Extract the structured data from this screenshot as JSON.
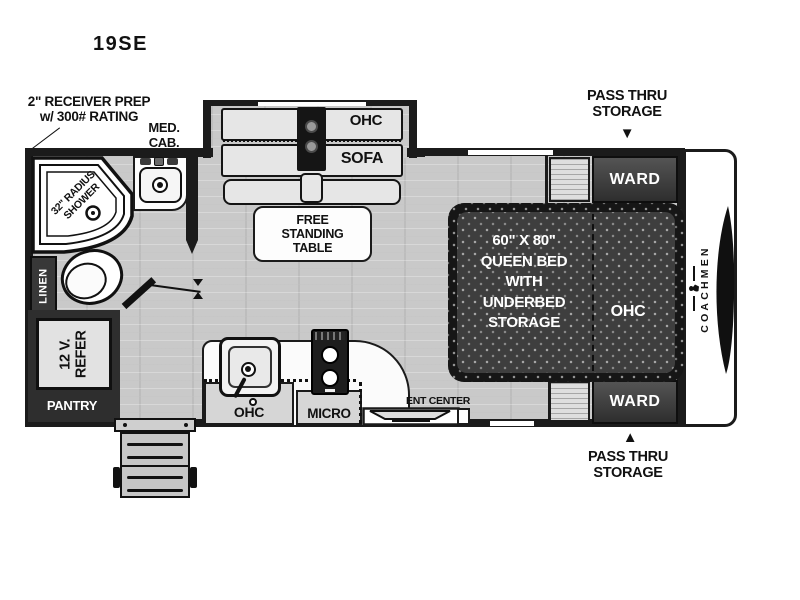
{
  "colors": {
    "wall": "#1b1b1b",
    "floor": "#c9c9c9",
    "bed": "#3e3e3e",
    "cabinet-dark": "#383838",
    "furniture-light": "#e6e6e6",
    "label-ink": "#111111"
  },
  "title": "19SE",
  "callouts": {
    "receiver_line1": "2\" RECEIVER PREP",
    "receiver_line2": "w/ 300# RATING",
    "med_cab_line1": "MED.",
    "med_cab_line2": "CAB.",
    "pass_thru_top_line1": "PASS THRU",
    "pass_thru_top_line2": "STORAGE",
    "pass_thru_top_arrow": "▼",
    "pass_thru_bottom_arrow": "▲",
    "pass_thru_bottom_line1": "PASS THRU",
    "pass_thru_bottom_line2": "STORAGE"
  },
  "bath": {
    "shower_line1": "32\" RADIUS",
    "shower_line2": "SHOWER",
    "linen": "LINEN"
  },
  "galley": {
    "refer_line1": "12 V.",
    "refer_line2": "REFER",
    "pantry": "PANTRY",
    "ohc": "OHC",
    "micro": "MICRO",
    "ent_center": "ENT CENTER"
  },
  "living": {
    "ohc": "OHC",
    "sofa": "SOFA",
    "table_line1": "FREE",
    "table_line2": "STANDING",
    "table_line3": "TABLE"
  },
  "bedroom": {
    "bed_line1": "60\" X 80\"",
    "bed_line2": "QUEEN BED",
    "bed_line3": "WITH",
    "bed_line4": "UNDERBED",
    "bed_line5": "STORAGE",
    "ohc": "OHC",
    "ward_top": "WARD",
    "ward_bottom": "WARD"
  },
  "brand": {
    "name": "COACHMEN"
  }
}
